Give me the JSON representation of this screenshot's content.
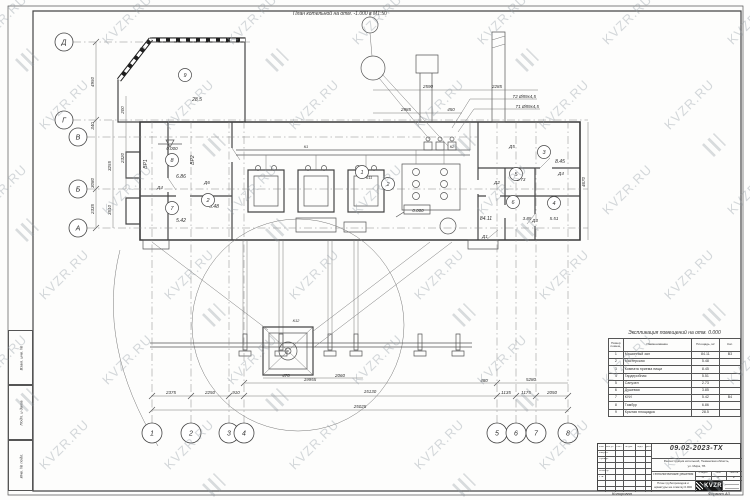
{
  "sheet": {
    "title": "План котельной на отм. -1.000 в М1:50",
    "watermark": {
      "text": "KVZR.RU",
      "color": "#97a0a8"
    },
    "copied_note": "Копировал",
    "format_note": "Формат А3"
  },
  "axes": {
    "rows": [
      {
        "label": "Д",
        "x": 64,
        "y": 42,
        "line_to": 250
      },
      {
        "label": "Г",
        "x": 64,
        "y": 120,
        "line_to": 588
      },
      {
        "label": "В",
        "x": 78,
        "y": 137,
        "line_to": 478
      },
      {
        "label": "Б",
        "x": 78,
        "y": 189,
        "line_to": 588
      },
      {
        "label": "А",
        "x": 78,
        "y": 228,
        "line_to": 588
      }
    ],
    "cols": [
      {
        "label": "1",
        "x": 152,
        "y": 433
      },
      {
        "label": "2",
        "x": 191,
        "y": 433
      },
      {
        "label": "3",
        "x": 229,
        "y": 433
      },
      {
        "label": "4",
        "x": 244,
        "y": 433
      },
      {
        "label": "5",
        "x": 497,
        "y": 433
      },
      {
        "label": "6",
        "x": 516,
        "y": 433
      },
      {
        "label": "7",
        "x": 536,
        "y": 433
      },
      {
        "label": "8",
        "x": 568,
        "y": 433
      }
    ]
  },
  "dimensions": [
    {
      "text": "4950",
      "x": 94,
      "y": 82,
      "rot": -90
    },
    {
      "text": "340",
      "x": 94,
      "y": 126,
      "rot": -90
    },
    {
      "text": "3080",
      "x": 94,
      "y": 183,
      "rot": -90
    },
    {
      "text": "2335",
      "x": 94,
      "y": 209,
      "rot": -90
    },
    {
      "text": "3255",
      "x": 111,
      "y": 166,
      "rot": -90
    },
    {
      "text": "3510",
      "x": 111,
      "y": 210,
      "rot": -90
    },
    {
      "text": "200",
      "x": 124,
      "y": 110,
      "rot": -90
    },
    {
      "text": "2320",
      "x": 124,
      "y": 158,
      "rot": -90
    },
    {
      "text": "4670",
      "x": 585,
      "y": 182,
      "rot": -90
    },
    {
      "text": "2590",
      "x": 428,
      "y": 88,
      "rot": 0
    },
    {
      "text": "2285",
      "x": 497,
      "y": 88,
      "rot": 0
    },
    {
      "text": "2985",
      "x": 406,
      "y": 111,
      "rot": 0
    },
    {
      "text": "450",
      "x": 451,
      "y": 111,
      "rot": 0
    },
    {
      "text": "19955",
      "x": 310,
      "y": 381,
      "rot": 0
    },
    {
      "text": "480",
      "x": 484,
      "y": 382,
      "rot": 0
    },
    {
      "text": "5280",
      "x": 531,
      "y": 381,
      "rot": 0
    },
    {
      "text": "2375",
      "x": 171,
      "y": 394,
      "rot": 0
    },
    {
      "text": "2250",
      "x": 210,
      "y": 394,
      "rot": 0
    },
    {
      "text": "910",
      "x": 236,
      "y": 394,
      "rot": 0
    },
    {
      "text": "15130",
      "x": 370,
      "y": 393,
      "rot": 0
    },
    {
      "text": "1135",
      "x": 506,
      "y": 394,
      "rot": 0
    },
    {
      "text": "1175",
      "x": 526,
      "y": 394,
      "rot": 0
    },
    {
      "text": "2050",
      "x": 552,
      "y": 394,
      "rot": 0
    },
    {
      "text": "25025",
      "x": 360,
      "y": 408,
      "rot": 0
    },
    {
      "text": "470",
      "x": 286,
      "y": 377,
      "rot": 0
    },
    {
      "text": "2060",
      "x": 340,
      "y": 377,
      "rot": 0
    }
  ],
  "plan": {
    "labels": [
      {
        "text": "ВР1",
        "x": 147,
        "y": 164,
        "rot": -90,
        "fs": 5
      },
      {
        "text": "ВР2",
        "x": 194,
        "y": 160,
        "rot": -90,
        "fs": 5
      },
      {
        "text": "КВ",
        "x": 142,
        "y": 50,
        "rot": 0,
        "fs": 4
      },
      {
        "text": "Д4",
        "x": 160,
        "y": 189,
        "rot": 0,
        "fs": 4.5
      },
      {
        "text": "Д6",
        "x": 207,
        "y": 184,
        "rot": 0,
        "fs": 4.5
      },
      {
        "text": "Д5",
        "x": 512,
        "y": 148,
        "rot": 0,
        "fs": 4.5
      },
      {
        "text": "Д2",
        "x": 497,
        "y": 184,
        "rot": 0,
        "fs": 4.5
      },
      {
        "text": "Д1",
        "x": 485,
        "y": 238,
        "rot": 0,
        "fs": 4.5
      },
      {
        "text": "Д3",
        "x": 535,
        "y": 222,
        "rot": 0,
        "fs": 4.5
      },
      {
        "text": "Д4",
        "x": 561,
        "y": 175,
        "rot": 0,
        "fs": 4.5
      },
      {
        "text": "28.5",
        "x": 197,
        "y": 101,
        "rot": 0,
        "fs": 5
      },
      {
        "text": "6.86",
        "x": 181,
        "y": 178,
        "rot": 0,
        "fs": 5
      },
      {
        "text": "5.48",
        "x": 214,
        "y": 208,
        "rot": 0,
        "fs": 5
      },
      {
        "text": "5.42",
        "x": 181,
        "y": 222,
        "rot": 0,
        "fs": 5
      },
      {
        "text": "84.11",
        "x": 486,
        "y": 220,
        "rot": 0,
        "fs": 5
      },
      {
        "text": "8.45",
        "x": 560,
        "y": 163,
        "rot": 0,
        "fs": 5
      },
      {
        "text": "2.73",
        "x": 521,
        "y": 181,
        "rot": 0,
        "fs": 4.5
      },
      {
        "text": "3.85",
        "x": 527,
        "y": 220,
        "rot": 0,
        "fs": 4.5
      },
      {
        "text": "5.51",
        "x": 554,
        "y": 220,
        "rot": 0,
        "fs": 4.5
      },
      {
        "text": "К1",
        "x": 306,
        "y": 148,
        "rot": 0,
        "fs": 4
      },
      {
        "text": "К2",
        "x": 452,
        "y": 148,
        "rot": 0,
        "fs": 4
      },
      {
        "text": "К11",
        "x": 369,
        "y": 179,
        "rot": 0,
        "fs": 4
      },
      {
        "text": "К12",
        "x": 296,
        "y": 322,
        "rot": 0,
        "fs": 4
      },
      {
        "text": "Т2 Ø89х4,5",
        "x": 536,
        "y": 98,
        "rot": 0,
        "fs": 4.5,
        "anchor": "end"
      },
      {
        "text": "Т1 Ø89х4,5",
        "x": 539,
        "y": 108,
        "rot": 0,
        "fs": 4.5,
        "anchor": "end"
      },
      {
        "text": "0.000",
        "x": 172,
        "y": 150,
        "rot": 0,
        "fs": 4.5
      },
      {
        "text": "0.000",
        "x": 418,
        "y": 212,
        "rot": 0,
        "fs": 4.5
      }
    ],
    "circles": [
      {
        "n": "9",
        "x": 185,
        "y": 75
      },
      {
        "n": "8",
        "x": 172,
        "y": 160
      },
      {
        "n": "2",
        "x": 208,
        "y": 200
      },
      {
        "n": "7",
        "x": 172,
        "y": 208
      },
      {
        "n": "1",
        "x": 362,
        "y": 172
      },
      {
        "n": "2",
        "x": 388,
        "y": 184
      },
      {
        "n": "3",
        "x": 544,
        "y": 152
      },
      {
        "n": "5",
        "x": 516,
        "y": 174
      },
      {
        "n": "6",
        "x": 513,
        "y": 202
      },
      {
        "n": "4",
        "x": 554,
        "y": 203
      }
    ]
  },
  "explication": {
    "title": "Экспликация помещений на отм. 0.000",
    "col_headers": [
      "Номер помещ.",
      "Наименование",
      "Площадь, м²",
      "Кат."
    ],
    "rows": [
      [
        "1",
        "Машинный зал",
        "84.11",
        "В3"
      ],
      [
        "2",
        "Мастерская",
        "5.48",
        ""
      ],
      [
        "3",
        "Комната приема пищи",
        "8.45",
        ""
      ],
      [
        "4",
        "Гардеробная",
        "5.51",
        ""
      ],
      [
        "5",
        "Санузел",
        "2.73",
        ""
      ],
      [
        "6",
        "Душевая",
        "3.85",
        ""
      ],
      [
        "7",
        "КУИ",
        "5.42",
        "В4"
      ],
      [
        "8",
        "Тамбур",
        "6.86",
        ""
      ],
      [
        "9",
        "Крытая площадка",
        "28.5",
        ""
      ]
    ]
  },
  "title_block": {
    "doc_number": "09.02-2023-ТХ",
    "object_line1": "Реконструкция котельной, Тюменская область,",
    "object_line2": "ул. Мира, 7Б",
    "section": "Технологические решения",
    "stage_headers": [
      "Стадия",
      "Лист",
      "Листов"
    ],
    "stage_values": [
      "П",
      "2",
      "2"
    ],
    "name_line1": "План трубопроводов и",
    "name_line2": "арматуры на отметку 0.000",
    "logo_text": "KVZR",
    "header_cells": [
      "Изм.",
      "Кол.уч.",
      "Лист",
      "№ док.",
      "Подп.",
      "Дата"
    ],
    "left_rows": [
      "Разраб.",
      "Провер.",
      "",
      "Н.контр.",
      "Утв."
    ]
  },
  "side_strip": [
    "Взам. инв. №",
    "Подп. и дата",
    "Инв. № подл."
  ]
}
